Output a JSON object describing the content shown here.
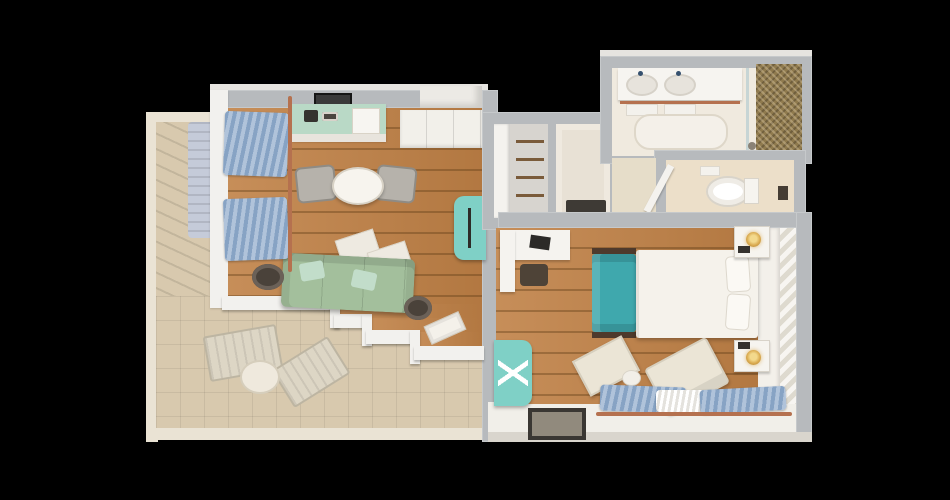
{
  "title": "one-bedroom-suite-3d-floor-plan-top-view",
  "palette": {
    "wall": "#b7babd",
    "wallface": "#f2f1ee",
    "terracewall": "#eae3d4",
    "wood": "#c08146",
    "terrace": "#d8c9ae",
    "bath": "#f0eadf",
    "wc": "#ecdfc9",
    "mosaic": "#8f7a4e",
    "sofa": "#a3bf9c",
    "pillow": "#c2ddca",
    "island": "#b9d9c6",
    "teal": "#7fd0c6",
    "bedteal": "#3fa8ad",
    "white": "#f5f2ec",
    "curtain": "#87a3c4",
    "copper": "#b5714f",
    "chairgray": "#b6b2ab",
    "darkwood": "#48403a",
    "gold": "#d9a94e",
    "closet": "#d7d4cf",
    "panel": "#e8e1d5",
    "background": "#000000"
  },
  "rooms": [
    {
      "name": "terrace",
      "floor": "beige-tile",
      "furniture": [
        "sun-lounger",
        "sun-lounger",
        "round-side-table",
        "planter-box"
      ]
    },
    {
      "name": "living-room",
      "floor": "wood-planks",
      "furniture": [
        "kitchen-island",
        "coffee-machine",
        "cup-tray",
        "serving-tray",
        "wall-tv",
        "round-dining-table",
        "dining-chair",
        "dining-chair",
        "floor-cushion",
        "floor-cushion",
        "sofa",
        "throw-pillow",
        "throw-pillow",
        "side-table",
        "side-table",
        "floor-tray",
        "accent-armchair",
        "window-curtains",
        "curtain-rod",
        "entry-step",
        "sideboard"
      ]
    },
    {
      "name": "wardrobe-closet",
      "floor": "gray",
      "furniture": [
        "shelf-column",
        "hanging-rails"
      ]
    },
    {
      "name": "entry-closet",
      "floor": "beige",
      "furniture": [
        "bench"
      ]
    },
    {
      "name": "bathroom",
      "floor": "light-stone",
      "furniture": [
        "double-vanity",
        "sink",
        "sink",
        "towel-rail",
        "towels",
        "bath-mat",
        "glass-shower-screen",
        "mosaic-feature-wall"
      ]
    },
    {
      "name": "water-closet",
      "floor": "beige",
      "furniture": [
        "toilet",
        "open-door",
        "shelf"
      ]
    },
    {
      "name": "bedroom",
      "floor": "wood-planks",
      "furniture": [
        "desk",
        "laptop",
        "desk-stool",
        "double-bed",
        "pillow",
        "pillow",
        "bed-end-sofa",
        "nightstand",
        "table-lamp",
        "nightstand",
        "table-lamp",
        "teal-bench",
        "lounge-chair",
        "ottoman",
        "round-pouf",
        "window-curtains",
        "sheer-curtains",
        "curtain-rod",
        "floor-mat-artwork",
        "headboard-panel",
        "chevron-tile-wall"
      ]
    }
  ]
}
